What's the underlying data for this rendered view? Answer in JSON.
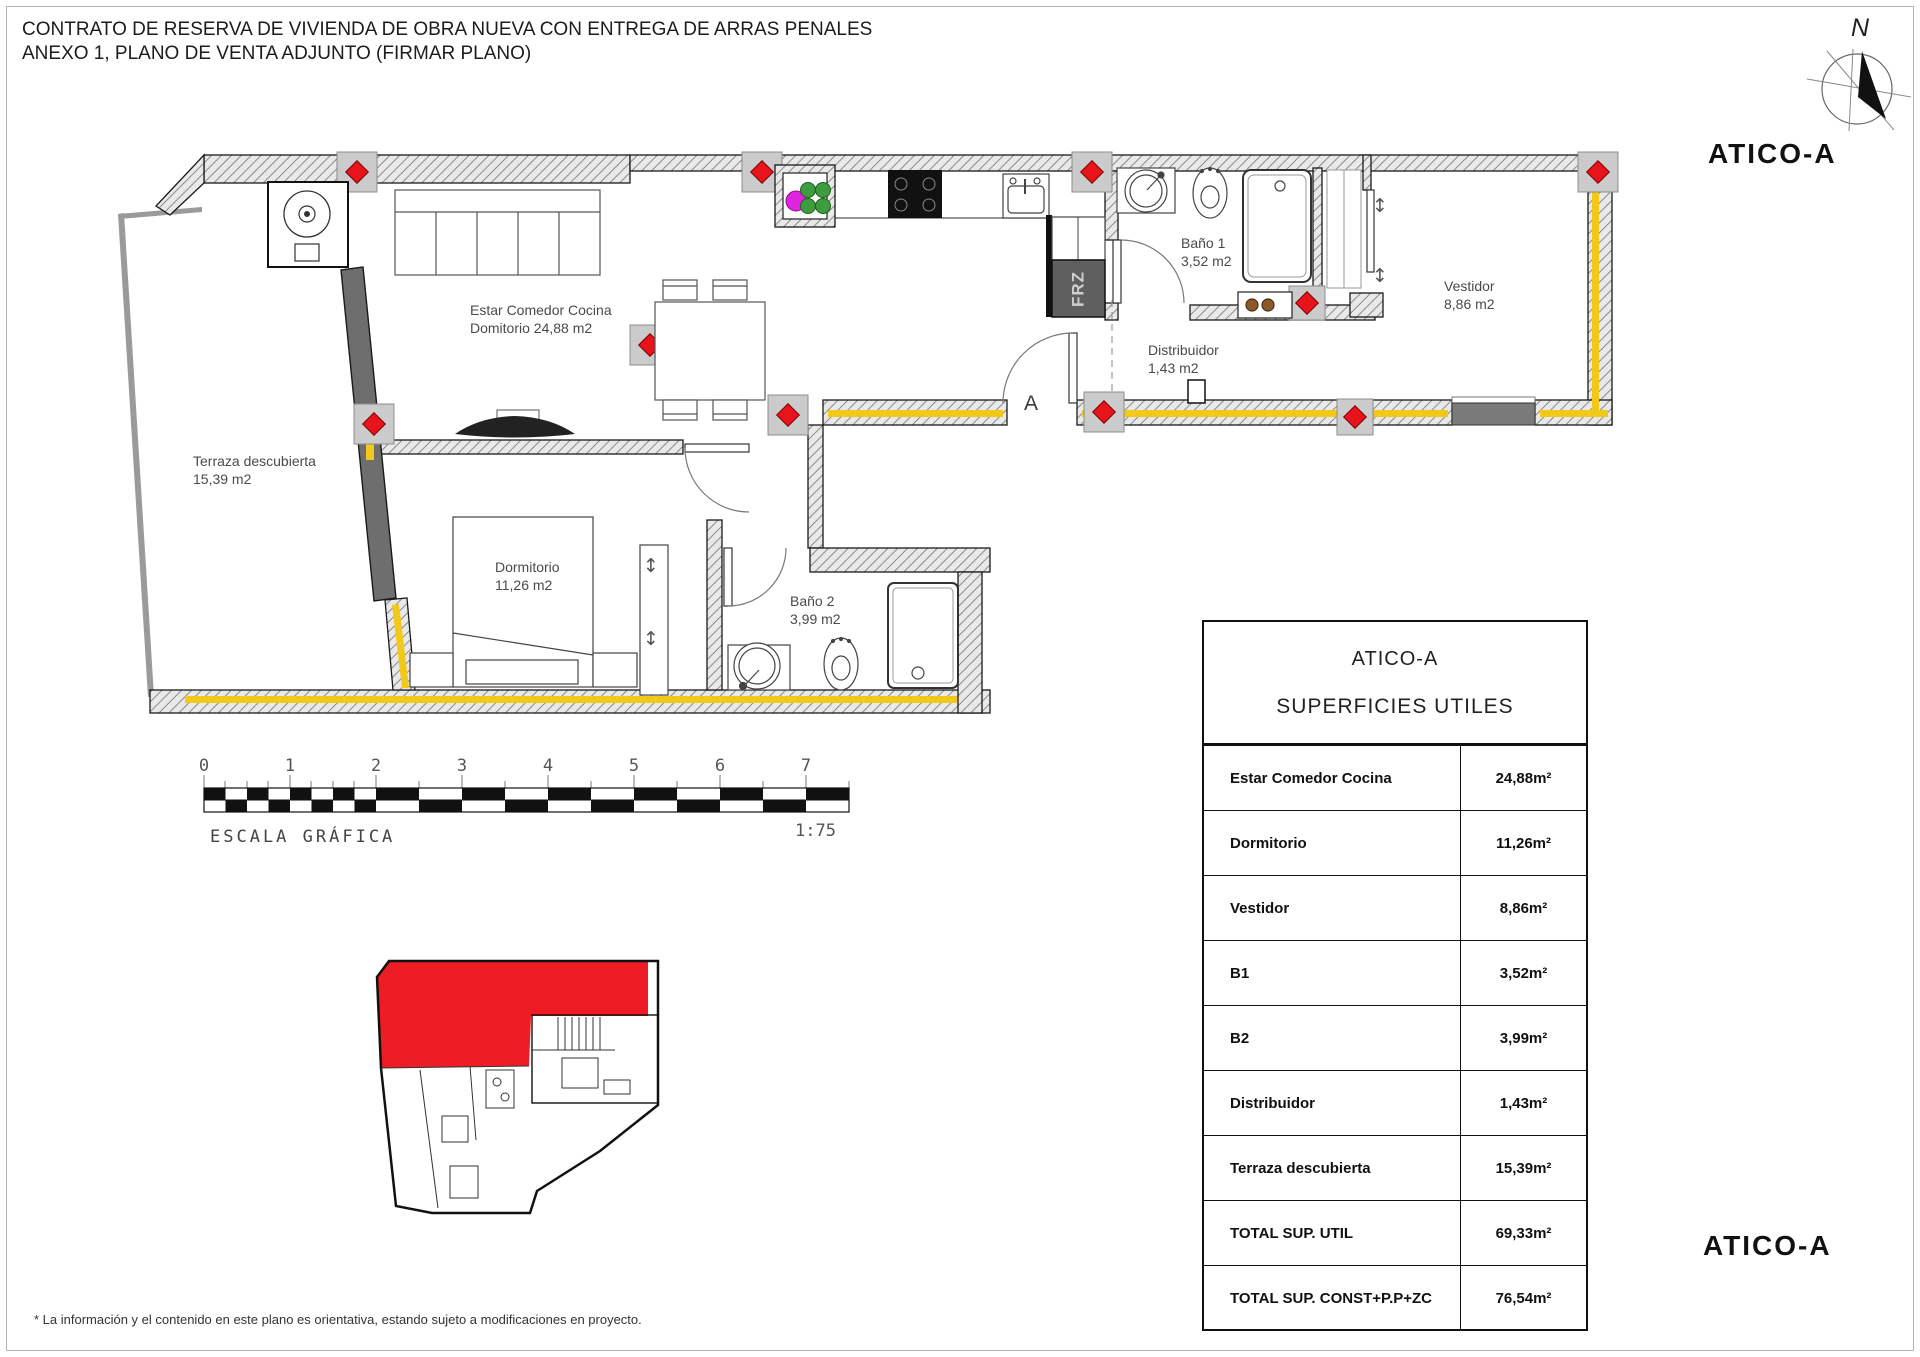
{
  "page": {
    "title_line1": "CONTRATO DE RESERVA DE VIVIENDA DE OBRA NUEVA CON ENTREGA DE ARRAS PENALES",
    "title_line2": "ANEXO 1, PLANO DE VENTA ADJUNTO (FIRMAR PLANO)",
    "disclaimer": "* La información y el contenido en este plano es orientativa, estando sujeto a modificaciones en proyecto.",
    "unit_label_top": "ATICO-A",
    "unit_label_bottom": "ATICO-A",
    "compass_north": "N"
  },
  "plan": {
    "entrance_label": "A",
    "appliance_label": "FRZ",
    "rooms": {
      "estar": {
        "line1": "Estar Comedor Cocina",
        "line2": "Domitorio 24,88 m2"
      },
      "terraza": {
        "line1": "Terraza descubierta",
        "line2": "15,39 m2"
      },
      "dormitorio": {
        "line1": "Dormitorio",
        "line2": "11,26 m2"
      },
      "bano2": {
        "line1": "Baño 2",
        "line2": "3,99 m2"
      },
      "bano1": {
        "line1": "Baño 1",
        "line2": "3,52 m2"
      },
      "distribuidor": {
        "line1": "Distribuidor",
        "line2": "1,43 m2"
      },
      "vestidor": {
        "line1": "Vestidor",
        "line2": "8,86 m2"
      }
    }
  },
  "scale_bar": {
    "ticks": [
      "0",
      "1",
      "2",
      "3",
      "4",
      "5",
      "6",
      "7"
    ],
    "caption": "ESCALA GRÁFICA",
    "ratio": "1:75"
  },
  "surface_table": {
    "title": "ATICO-A",
    "subtitle": "SUPERFICIES UTILES",
    "rows": [
      {
        "label": "Estar Comedor Cocina",
        "value": "24,88m²"
      },
      {
        "label": "Dormitorio",
        "value": "11,26m²"
      },
      {
        "label": "Vestidor",
        "value": "8,86m²"
      },
      {
        "label": "B1",
        "value": "3,52m²"
      },
      {
        "label": "B2",
        "value": "3,99m²"
      },
      {
        "label": "Distribuidor",
        "value": "1,43m²"
      },
      {
        "label": "Terraza descubierta",
        "value": "15,39m²"
      },
      {
        "label": "TOTAL SUP. UTIL",
        "value": "69,33m²"
      },
      {
        "label": "TOTAL SUP. CONST+P.P+ZC",
        "value": "76,54m²"
      }
    ]
  },
  "colors": {
    "highlight_red": "#ee1c25",
    "insulation_yellow": "#f2c918",
    "glazing_gray": "#6e6e6e",
    "accent_magenta": "#df24df",
    "accent_green": "#3f9b3f"
  }
}
